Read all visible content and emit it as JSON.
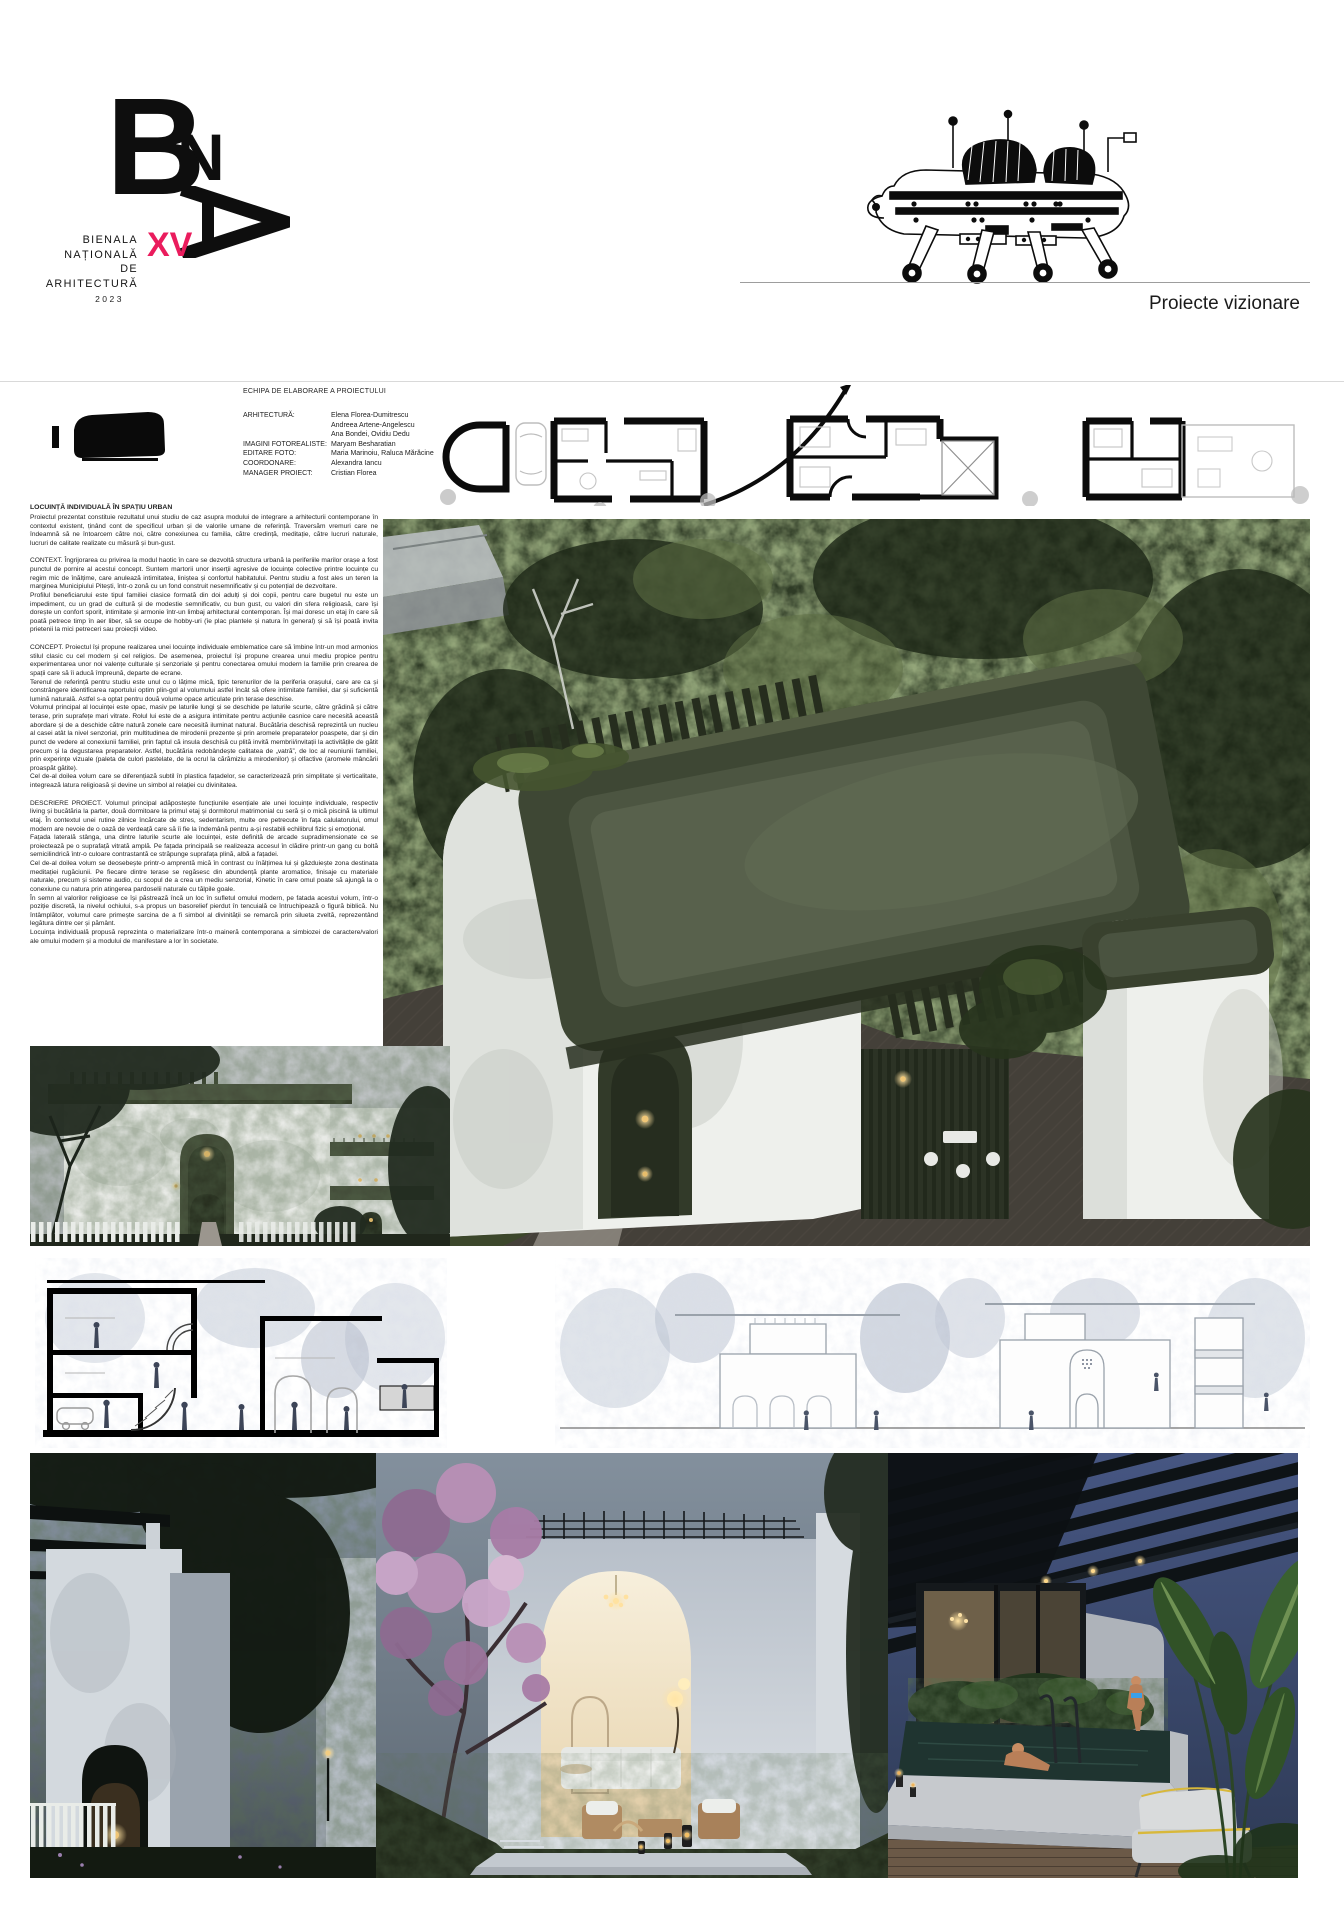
{
  "header": {
    "logo": {
      "letter_b": "B",
      "letter_n": "N",
      "name_lines": [
        "BIENALA",
        "NAȚIONALĂ",
        "DE",
        "ARHITECTURĂ"
      ],
      "year": "2023",
      "edition": "XV"
    },
    "category_label": "Proiecte vizionare"
  },
  "credits": {
    "heading": "ECHIPA DE ELABORARE A PROIECTULUI",
    "rows": [
      {
        "label": "ARHITECTURĂ:",
        "value": "Elena Florea-Dumitrescu"
      },
      {
        "label": "",
        "value": "Andreea Artene-Angelescu"
      },
      {
        "label": "",
        "value": "Ana Bondei, Ovidiu Dedu"
      },
      {
        "label": "IMAGINI FOTOREALISTE:",
        "value": "Maryam Besharatian"
      },
      {
        "label": "EDITARE FOTO:",
        "value": "Maria Marinoiu, Raluca Mărăcine"
      },
      {
        "label": "COORDONARE:",
        "value": "Alexandra Iancu"
      },
      {
        "label": "MANAGER PROIECT:",
        "value": "Cristian Florea"
      }
    ]
  },
  "article": {
    "title": "LOCUINȚĂ INDIVIDUALĂ ÎN SPAȚIU URBAN",
    "groups": [
      [
        "Proiectul prezentat constituie rezultatul unui studiu de caz asupra modului de integrare a arhitecturii contemporane în contextul existent, ținând cont de specificul urban și de valorile umane de referință. Traversăm vremuri care ne îndeamnă să ne întoarcem către noi, către conexiunea cu familia,  către credință, meditație, către lucruri naturale, lucruri de calitate realizate cu măsură și bun-gust."
      ],
      [
        "CONTEXT.  Îngrijorarea cu privirea la modul haotic în care se dezvoltă structura urbană la periferiile marilor orașe a fost punctul de pornire al acestui concept. Suntem martorii unor inserții agresive de locuințe colective printre locuințe cu regim mic de înălțime, care anulează intimitatea, liniștea și confortul habitatului. Pentru studiu a fost ales un teren la marginea Municipiului Pitești, într-o zonă cu un fond construit nesemnificativ și cu potențial de dezvoltare.",
        "Profilul beneficiarului este tipul familiei clasice formată din doi adulți și doi copii, pentru care bugetul nu este un impediment, cu un grad de cultură și de modestie semnificativ, cu bun gust, cu valori din sfera religioasă, care își dorește un confort sporit, intimitate și armonie într-un limbaj arhitectural contemporan. Își mai doresc  un etaj în care să poată petrece timp în aer liber, să se ocupe de hobby-uri (îe plac plantele și natura în general) și să își poată invita prietenii la mici petreceri sau proiecții video."
      ],
      [
        "CONCEPT. Proiectul își propune realizarea unei locuințe individuale emblematice care să îmbine într-un mod armonios stilul clasic cu cel modern și cel religios. De asemenea, proiectul își propune crearea unui mediu propice pentru experimentarea unor noi valențe culturale și senzoriale și pentru conectarea omului modern  la familie prin crearea de spații care să îi aducă împreună, departe de ecrane.",
        "Terenul de referință pentru studiu este unul cu o lățime mică, tipic terenurilor de la periferia orașului, care are ca și constrângere identificarea raportului optim plin-gol al volumului astfel încât să ofere intimitate familiei, dar și suficientă lumină naturală. Astfel s-a optat pentru două volume opace articulate prin terase deschise.",
        "Volumul principal al locuinței este opac, masiv pe laturile lungi și se deschide pe laturile scurte, către grădină și către terase, prin suprafețe mari vitrate. Rolul lui este de a asigura intimitate pentru acțiunile casnice care necesită  această abordare și de a deschide către natură zonele care necesită iluminat natural. Bucătăria deschisă reprezintă un nucleu al casei atât la nivel senzorial, prin multitudinea de mirodenii prezente și prin aromele preparatelor poaspete, dar și din punct de vedere al conexiunii familiei, prin faptul că insula deschisă cu plită invită membrii/invitații la activitățile de gătit precum și la degustarea preparatelor.  Astfel, bucătăria redobândește calitatea de „vatră”, de loc al reuniunii familiei, prin experințe  vizuale (paleta de culori pastelate, de la ocrul la cărămiziu a mirodenilor) și olfactive (aromele mâncării proaspăt gătite).",
        "Cel de-al doilea volum care se diferențiază subtil în plastica fațadelor, se caracterizează prin simplitate și verticalitate, integrează latura religioasă și devine un simbol al relației cu divinitatea."
      ],
      [
        "DESCRIERE PROIECT. Volumul principal adăpostește funcțiunile esențiale ale unei locuințe individuale, respectiv living și bucătăria la parter, două dormitoare la primul etaj și dormitorul matrimonial cu seră și o mică piscină la ultimul etaj. În contextul unei rutine zilnice încărcate de stres, sedentarism, multe ore petrecute în fața calulatorului, omul modern are nevoie de o oază de verdeață care să îi fie la îndemână pentru a-și restabili echilibrul fizic și emoțional.",
        "Fațada laterală stânga, una dintre laturile scurte ale locuinței, este definită de arcade supradimensionate ce se proiectează pe o suprafață vitrată amplă. Pe fațada principală se realizeaza accesul în clădire printr-un gang cu boltă semicilindrică într-o culoare contrastantă ce străpunge suprafața plină, albă a fațadei.",
        "Cel de-al doilea volum se deosebește printr-o amprentă mică în contrast cu înălțimea lui și găzduiește zona destinata meditației rugăciunii. Pe fiecare dintre terase se regăsesc din abundență plante aromatice, finisaje cu materiale naturale, precum și sisteme audio, cu scopul de a crea un mediu senzorial, Kinetic în care omul poate să ajungă la o conexiune cu natura prin atingerea pardoselii naturale cu tălpile goale.",
        "În semn al valorilor religioase ce își păstrează încă un loc în sufletul omului modern, pe fatada acestui volum, într-o poziție discretă, la nivelul ochiului, s-a propus un basorelief pierdut în tencuială ce întruchipează o figură biblică. Nu întâmplător, volumul care primește sarcina de a fi simbol al divinității se remarcă prin silueta zveltă, reprezentând legătura dintre cer și pământ.",
        "Locuința individuală propusă reprezinta o materializare într-o maineră contemporana a simbiozei de caractere/valori ale omului modern și a modului de manifestare a lor în societate."
      ]
    ]
  },
  "colors": {
    "edition_pink": "#ea1c5d",
    "roof_olive": "#3e4734",
    "wall_white": "#f2f3f1",
    "paving_dark": "#454039",
    "night_sky": "#3f4f76"
  }
}
